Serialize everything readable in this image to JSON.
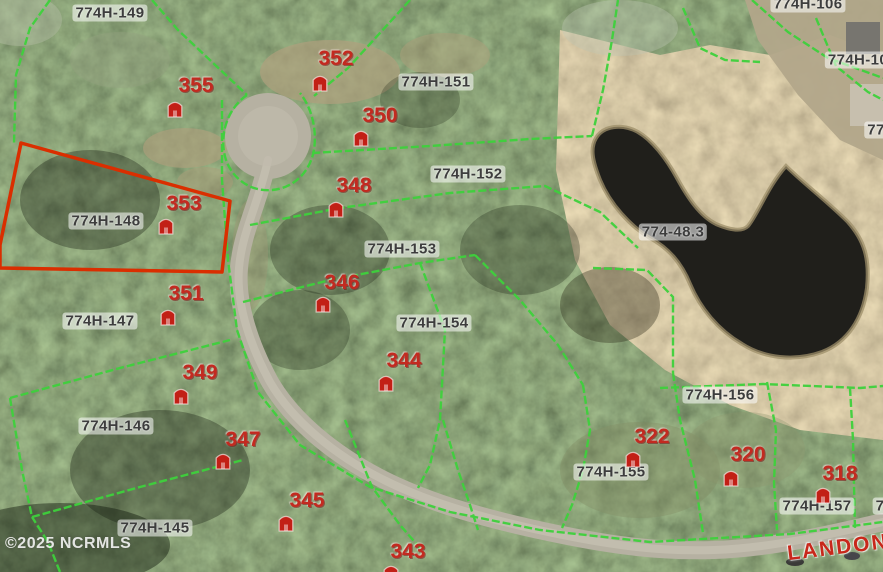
{
  "map": {
    "watermark": "©2025 NCRMLS",
    "road_label": "LANDON",
    "highlighted_parcel": {
      "lot": "353",
      "parcel_id": "774H-148"
    },
    "parcel_labels": [
      {
        "id": "774H-149",
        "x": 110,
        "y": 13
      },
      {
        "id": "774H-151",
        "x": 436,
        "y": 82
      },
      {
        "id": "774H-152",
        "x": 468,
        "y": 174
      },
      {
        "id": "774H-153",
        "x": 402,
        "y": 249
      },
      {
        "id": "774H-148",
        "x": 106,
        "y": 221
      },
      {
        "id": "774H-147",
        "x": 100,
        "y": 321
      },
      {
        "id": "774H-154",
        "x": 434,
        "y": 323
      },
      {
        "id": "774H-146",
        "x": 116,
        "y": 426
      },
      {
        "id": "774H-145",
        "x": 155,
        "y": 528
      },
      {
        "id": "774-48.3",
        "x": 673,
        "y": 232
      },
      {
        "id": "774H-156",
        "x": 720,
        "y": 395
      },
      {
        "id": "774H-155",
        "x": 611,
        "y": 472
      },
      {
        "id": "774H-157",
        "x": 817,
        "y": 506
      },
      {
        "id": "774H-106",
        "x": 808,
        "y": 4
      },
      {
        "id": "774H-10",
        "x": 858,
        "y": 60
      },
      {
        "id": "77",
        "x": 876,
        "y": 130
      },
      {
        "id": "7",
        "x": 880,
        "y": 506
      }
    ],
    "lot_markers": [
      {
        "number": "355",
        "tx": 196,
        "ty": 86,
        "ix": 166,
        "iy": 98
      },
      {
        "number": "352",
        "tx": 336,
        "ty": 59,
        "ix": 311,
        "iy": 72
      },
      {
        "number": "350",
        "tx": 380,
        "ty": 116,
        "ix": 352,
        "iy": 127
      },
      {
        "number": "348",
        "tx": 354,
        "ty": 186,
        "ix": 327,
        "iy": 198
      },
      {
        "number": "353",
        "tx": 184,
        "ty": 204,
        "ix": 157,
        "iy": 215
      },
      {
        "number": "351",
        "tx": 186,
        "ty": 294,
        "ix": 159,
        "iy": 306
      },
      {
        "number": "346",
        "tx": 342,
        "ty": 283,
        "ix": 314,
        "iy": 293
      },
      {
        "number": "344",
        "tx": 404,
        "ty": 361,
        "ix": 377,
        "iy": 372
      },
      {
        "number": "349",
        "tx": 200,
        "ty": 373,
        "ix": 172,
        "iy": 385
      },
      {
        "number": "347",
        "tx": 243,
        "ty": 440,
        "ix": 214,
        "iy": 450
      },
      {
        "number": "345",
        "tx": 307,
        "ty": 501,
        "ix": 277,
        "iy": 512
      },
      {
        "number": "343",
        "tx": 408,
        "ty": 552,
        "ix": 382,
        "iy": 562
      },
      {
        "number": "322",
        "tx": 652,
        "ty": 437,
        "ix": 624,
        "iy": 448
      },
      {
        "number": "320",
        "tx": 748,
        "ty": 455,
        "ix": 722,
        "iy": 467
      },
      {
        "number": "318",
        "tx": 840,
        "ty": 474,
        "ix": 814,
        "iy": 484
      }
    ],
    "colors": {
      "boundary_green": "#3ed13c",
      "highlight_red": "#da2e00",
      "lot_marker_red": "#c32a20",
      "parcel_label_gray": "#3d3d3d",
      "water": "#201f1b",
      "road": "#b6b1a2"
    }
  }
}
